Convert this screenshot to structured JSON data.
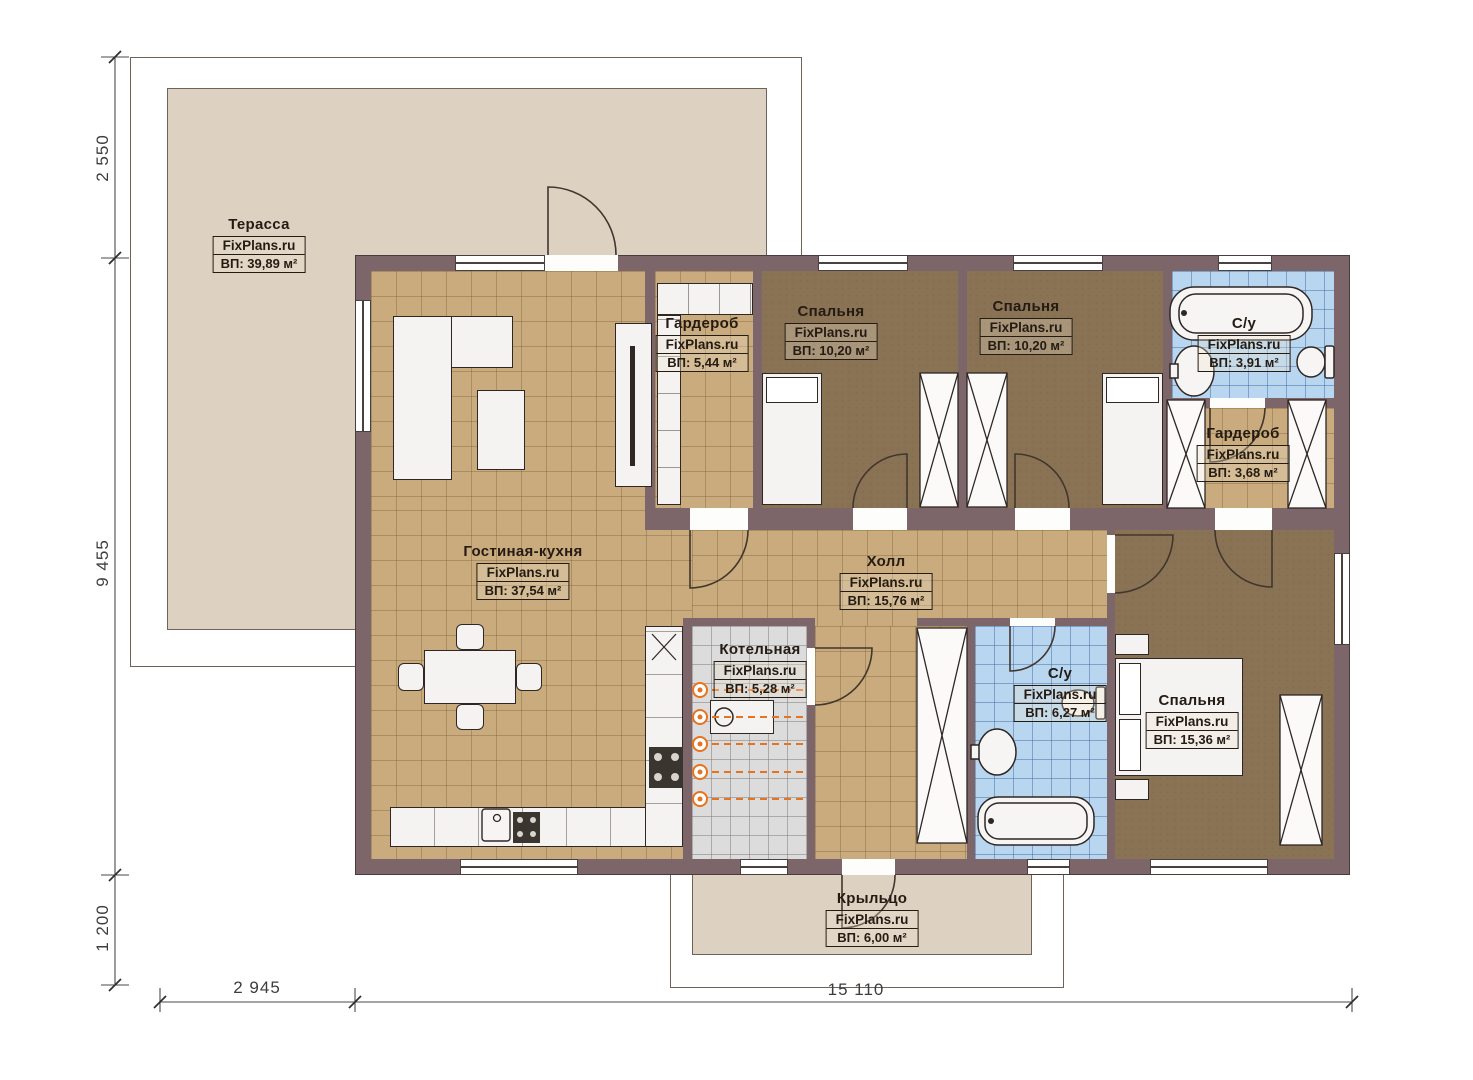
{
  "watermark": "FixPlans.ru",
  "rooms": [
    {
      "name": "Терасса",
      "area": "ВП: 39,89 м²"
    },
    {
      "name": "Гардероб",
      "area": "ВП: 5,44 м²"
    },
    {
      "name": "Спальня",
      "area": "ВП: 10,20 м²"
    },
    {
      "name": "Спальня",
      "area": "ВП: 10,20 м²"
    },
    {
      "name": "С/у",
      "area": "ВП: 3,91 м²"
    },
    {
      "name": "Гардероб",
      "area": "ВП: 3,68 м²"
    },
    {
      "name": "Гостиная-кухня",
      "area": "ВП: 37,54 м²"
    },
    {
      "name": "Холл",
      "area": "ВП: 15,76 м²"
    },
    {
      "name": "Котельная",
      "area": "ВП: 5,28 м²"
    },
    {
      "name": "С/у",
      "area": "ВП: 6,27 м²"
    },
    {
      "name": "Спальня",
      "area": "ВП: 15,36 м²"
    },
    {
      "name": "Крыльцо",
      "area": "ВП: 6,00 м²"
    }
  ],
  "dimensions": {
    "left_top": "2 550",
    "left_mid": "9 455",
    "left_bottom": "1 200",
    "bottom_left": "2 945",
    "bottom_right": "15 110"
  },
  "colors": {
    "wall": "#7d666a",
    "floor_tile_tan": "#c9ab7d",
    "floor_bedroom": "#8a7355",
    "floor_bath": "#b9d6f1",
    "floor_boiler": "#dcdcdc",
    "terrace": "#ddd2c2",
    "radiator": "#e8731e",
    "furniture": "#f4f3f1",
    "line": "#42362e"
  }
}
